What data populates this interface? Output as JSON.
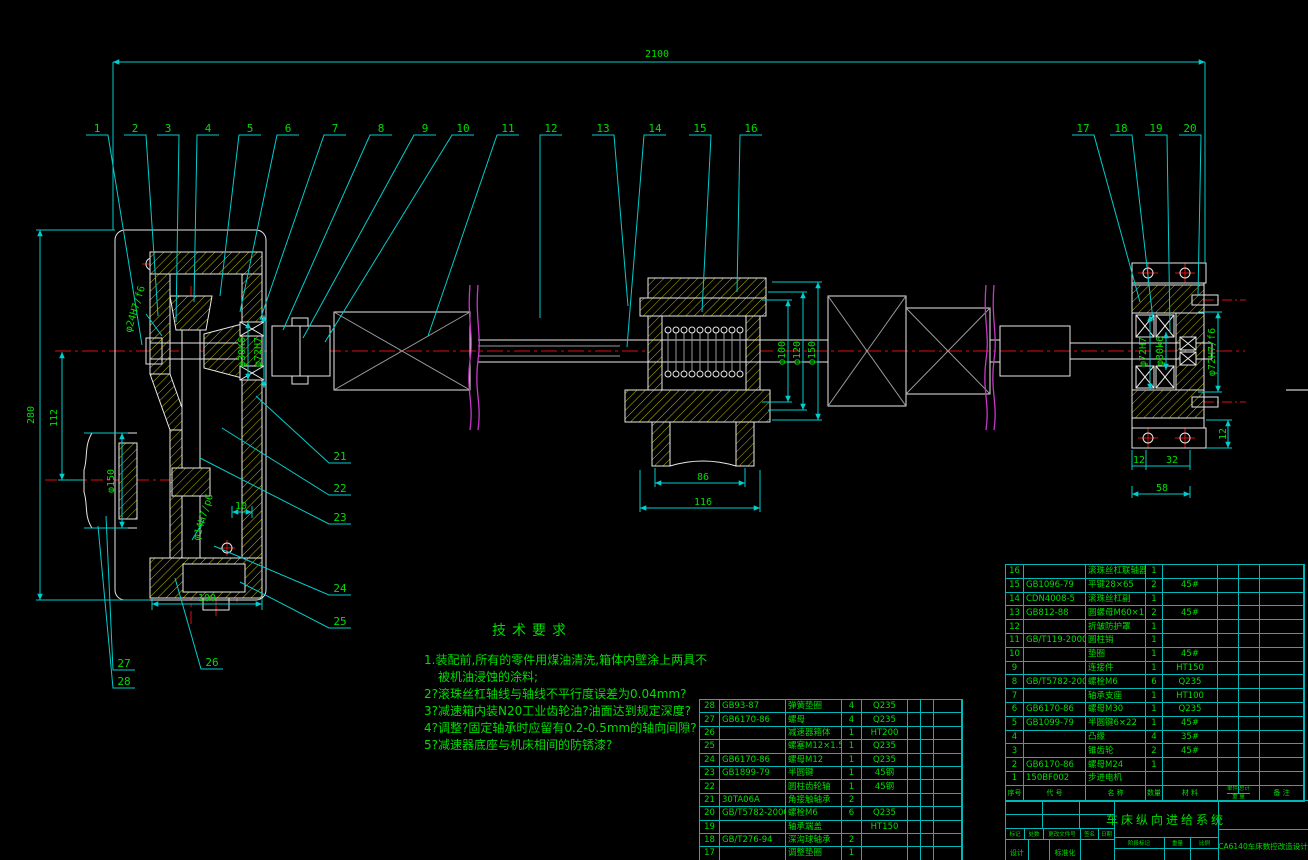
{
  "colors": {
    "line_cyan": "#00cdcd",
    "part_white": "#e8e8e8",
    "hatch_yellow": "#b8b800",
    "center_red": "#dd1111",
    "text_green": "#00dd00",
    "break_magenta": "#c837c8"
  },
  "drawing": {
    "callouts": [
      "1",
      "2",
      "3",
      "4",
      "5",
      "6",
      "7",
      "8",
      "9",
      "10",
      "11",
      "12",
      "13",
      "14",
      "15",
      "16",
      "17",
      "18",
      "19",
      "20",
      "21",
      "22",
      "23",
      "24",
      "25",
      "26",
      "27",
      "28"
    ],
    "dims": [
      "2100",
      "280",
      "112",
      "φ150",
      "φ24H7/f6",
      "φ30K6",
      "φ72H7",
      "φ14H7/p6",
      "10",
      "100",
      "86",
      "116",
      "φ100",
      "φ120",
      "φ150",
      "φ72H7",
      "φ30k6",
      "φ72H7/f6",
      "12",
      "12",
      "32",
      "58"
    ]
  },
  "tech": {
    "title": "技术要求",
    "lines": [
      "1.装配前,所有的零件用煤油清洗,箱体内壁涂上两具不",
      "被机油浸蚀的涂料;",
      "2?滚珠丝杠轴线与轴线不平行度误差为0.04mm?",
      "3?减速箱内装N20工业齿轮油?油面达到规定深度?",
      "4?调整?固定轴承时应留有0.2-0.5mm的轴向间隙?",
      "5?减速器底座与机床相间的防锈漆?"
    ]
  },
  "bom_header": {
    "no": "序号",
    "code": "代  号",
    "name": "名  称",
    "qty": "数量",
    "mat": "材  料",
    "unit": "单件",
    "total": "总计",
    "weight": "重 量",
    "note": "备  注"
  },
  "bom_right": {
    "rows": [
      {
        "no": "16",
        "code": "",
        "name": "滚珠丝杠联轴器",
        "qty": "1",
        "mat": ""
      },
      {
        "no": "15",
        "code": "GB1096-79",
        "name": "平键28×65",
        "qty": "2",
        "mat": "45#"
      },
      {
        "no": "14",
        "code": "CDN4008-5",
        "name": "滚珠丝杠副",
        "qty": "1",
        "mat": ""
      },
      {
        "no": "13",
        "code": "GB812-88",
        "name": "圆螺母M60×1.5",
        "qty": "2",
        "mat": "45#"
      },
      {
        "no": "12",
        "code": "",
        "name": "折皱防护罩",
        "qty": "1",
        "mat": ""
      },
      {
        "no": "11",
        "code": "GB/T119-2000",
        "name": "圆柱销",
        "qty": "1",
        "mat": ""
      },
      {
        "no": "10",
        "code": "",
        "name": "垫圈",
        "qty": "1",
        "mat": "45#"
      },
      {
        "no": "9",
        "code": "",
        "name": "连接件",
        "qty": "1",
        "mat": "HT150"
      },
      {
        "no": "8",
        "code": "GB/T5782-2000",
        "name": "螺栓M6",
        "qty": "6",
        "mat": "Q235"
      },
      {
        "no": "7",
        "code": "",
        "name": "轴承支座",
        "qty": "1",
        "mat": "HT100"
      },
      {
        "no": "6",
        "code": "GB6170-86",
        "name": "螺母M30",
        "qty": "1",
        "mat": "Q235"
      },
      {
        "no": "5",
        "code": "GB1099-79",
        "name": "半圆键6×22",
        "qty": "1",
        "mat": "45#"
      },
      {
        "no": "4",
        "code": "",
        "name": "凸缘",
        "qty": "4",
        "mat": "35#"
      },
      {
        "no": "3",
        "code": "",
        "name": "锥齿轮",
        "qty": "2",
        "mat": "45#"
      },
      {
        "no": "2",
        "code": "GB6170-86",
        "name": "螺母M24",
        "qty": "1",
        "mat": ""
      },
      {
        "no": "1",
        "code": "150BF002",
        "name": "步进电机",
        "qty": "",
        "mat": ""
      }
    ]
  },
  "bom_left": {
    "rows": [
      {
        "no": "28",
        "code": "GB93-87",
        "name": "弹簧垫圈",
        "qty": "4",
        "mat": "Q235"
      },
      {
        "no": "27",
        "code": "GB6170-86",
        "name": "螺母",
        "qty": "4",
        "mat": "Q235"
      },
      {
        "no": "26",
        "code": "",
        "name": "减速器箱体",
        "qty": "1",
        "mat": "HT200"
      },
      {
        "no": "25",
        "code": "",
        "name": "螺塞M12×1.5",
        "qty": "1",
        "mat": "Q235"
      },
      {
        "no": "24",
        "code": "GB6170-86",
        "name": "螺母M12",
        "qty": "1",
        "mat": "Q235"
      },
      {
        "no": "23",
        "code": "GB1899-79",
        "name": "半圆键",
        "qty": "1",
        "mat": "45钢"
      },
      {
        "no": "22",
        "code": "",
        "name": "圆柱齿轮轴",
        "qty": "1",
        "mat": "45钢"
      },
      {
        "no": "21",
        "code": "30TA06A",
        "name": "角接触轴承",
        "qty": "2",
        "mat": ""
      },
      {
        "no": "20",
        "code": "GB/T5782-2000",
        "name": "螺栓M6",
        "qty": "6",
        "mat": "Q235"
      },
      {
        "no": "19",
        "code": "",
        "name": "轴承端盖",
        "qty": "",
        "mat": "HT150"
      },
      {
        "no": "18",
        "code": "GB/T276-94",
        "name": "深沟球轴承",
        "qty": "2",
        "mat": ""
      },
      {
        "no": "17",
        "code": "",
        "name": "调整垫圈",
        "qty": "1",
        "mat": ""
      }
    ]
  },
  "tb": {
    "title": "车床纵向进给系统",
    "project": "CA6140车床数控改造设计",
    "mark": "标记",
    "count": "处数",
    "file": "更改文件号",
    "sign": "签名",
    "date": "日期",
    "design": "设计",
    "standard": "标准化",
    "stage": "阶段标记",
    "weight": "重量",
    "scale": "比例"
  }
}
